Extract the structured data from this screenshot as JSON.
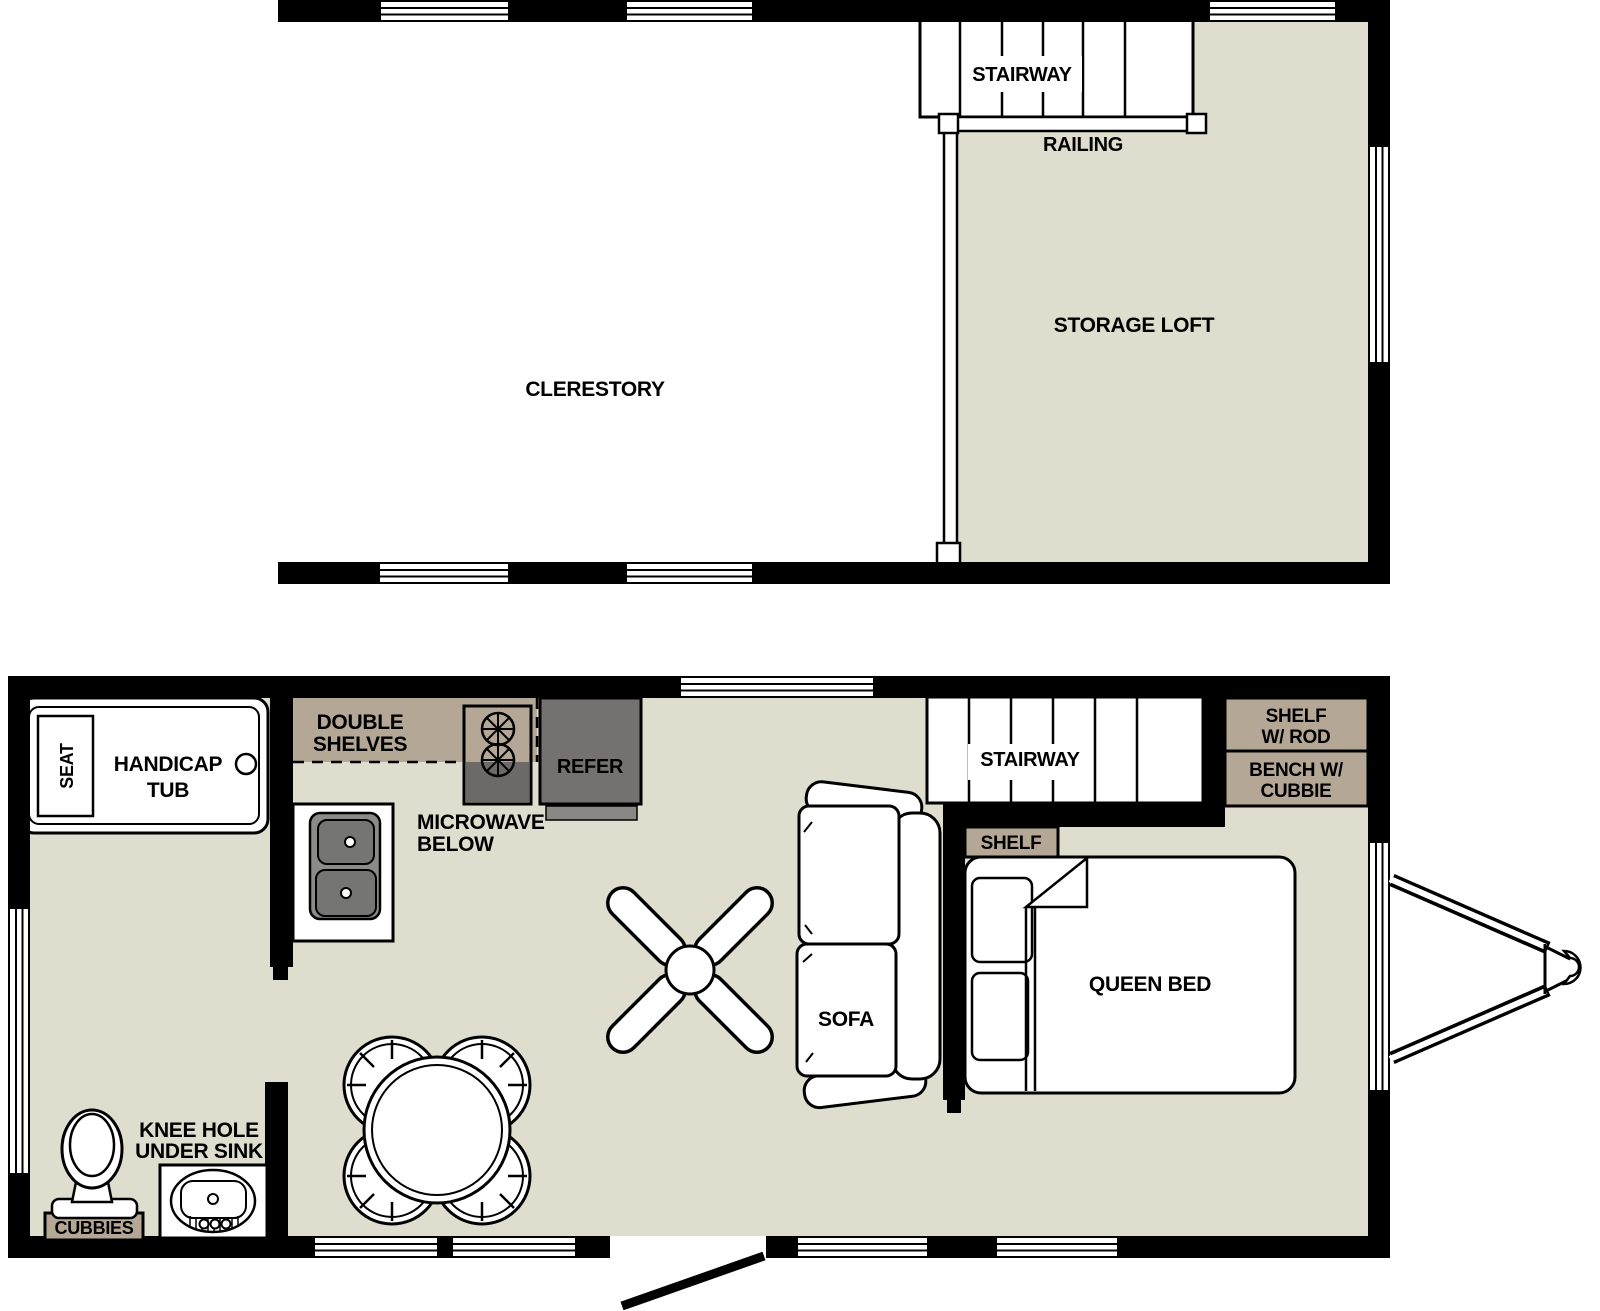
{
  "document": {
    "type": "floor-plan",
    "levels": [
      "upper loft level",
      "main level"
    ]
  },
  "colors": {
    "wall": "#000000",
    "floor": "#dfddcd",
    "cabinet_taupe": "#b4a796",
    "appliance_gray": "#757170",
    "appliance_strip_gray": "#8a8887",
    "sink_unit_gray": "#8b8b89",
    "sink_bowl_gray": "#757573",
    "stove_gray": "#6c6967",
    "window_white": "#ffffff"
  },
  "upper_floor": {
    "clerestory": "CLERESTORY",
    "stairway": "STAIRWAY",
    "railing": "RAILING",
    "storage_loft": "STORAGE LOFT"
  },
  "main_floor": {
    "bathroom": {
      "seat": "SEAT",
      "tub_line1": "HANDICAP",
      "tub_line2": "TUB",
      "knee_hole_line1": "KNEE HOLE",
      "knee_hole_line2": "UNDER SINK",
      "cubbies": "CUBBIES"
    },
    "kitchen": {
      "shelves_line1": "DOUBLE",
      "shelves_line2": "SHELVES",
      "microwave_line1": "MICROWAVE",
      "microwave_line2": "BELOW",
      "refrigerator": "REFER"
    },
    "living": {
      "sofa": "SOFA",
      "stairway": "STAIRWAY"
    },
    "bedroom": {
      "shelf": "SHELF",
      "queen_bed": "QUEEN BED",
      "shelf_rod_line1": "SHELF",
      "shelf_rod_line2": "W/ ROD",
      "bench_line1": "BENCH W/",
      "bench_line2": "CUBBIE"
    }
  }
}
